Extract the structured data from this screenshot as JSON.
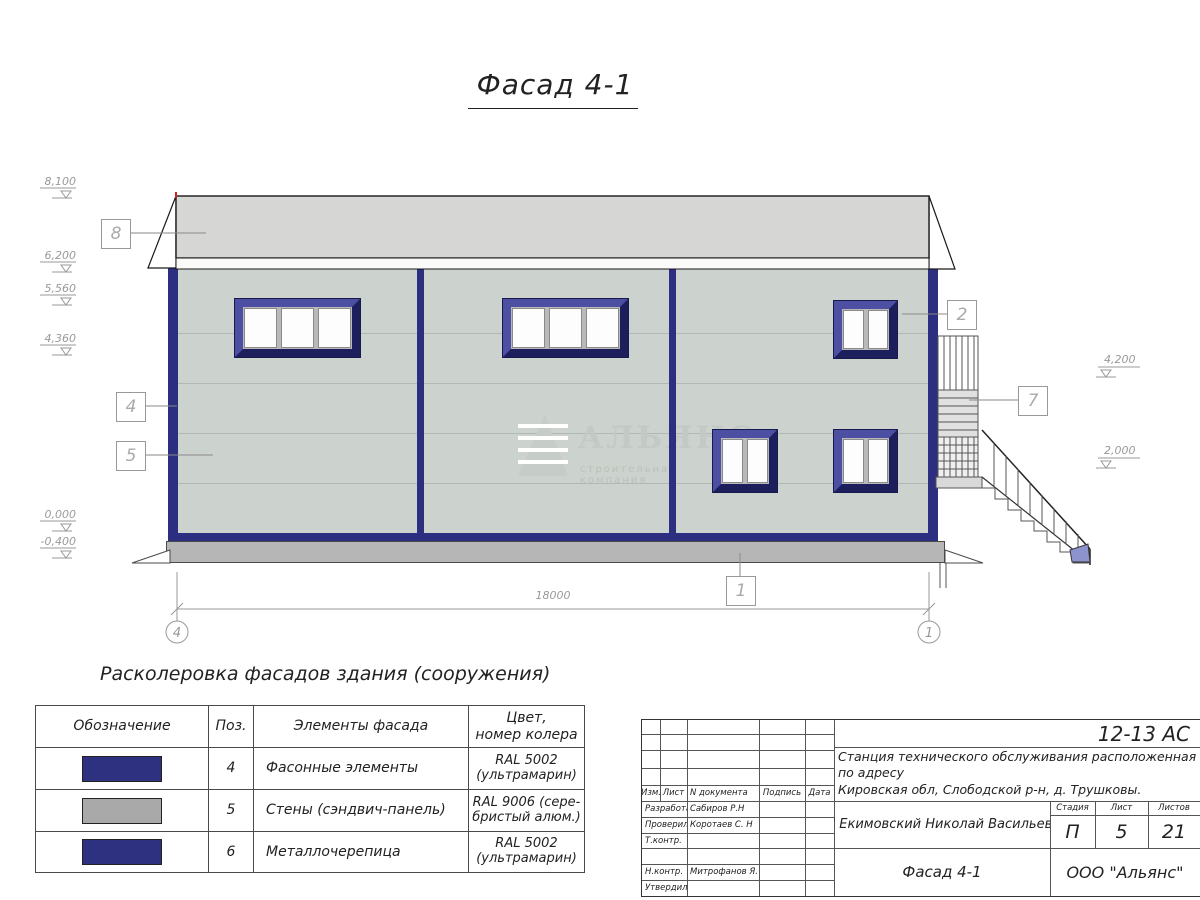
{
  "title": "Фасад 4-1",
  "colors": {
    "accent_navy": "#2e3180",
    "wall_gray_green": "#ccd2ce",
    "roof_gray": "#d6d7d5",
    "swatch_gray": "#a9a9a9"
  },
  "facade": {
    "elevations": [
      "8,100",
      "6,200",
      "5,560",
      "4,360",
      "0,000",
      "-0,400",
      "4,200",
      "2,000"
    ],
    "callouts": [
      "8",
      "4",
      "5",
      "2",
      "7",
      "1"
    ],
    "dimension_total": "18000",
    "axes": [
      "4",
      "1"
    ],
    "watermark": {
      "name": "АЛЬЯНС",
      "subtitle": "строительная компания"
    }
  },
  "legend": {
    "heading": "Расколеровка фасадов здания (сооружения)",
    "columns": {
      "c1": "Обозначение",
      "c2": "Поз.",
      "c3": "Элементы фасада",
      "c4a": "Цвет,",
      "c4b": "номер колера"
    },
    "rows": [
      {
        "pos": "4",
        "element": "Фасонные элементы",
        "color1": "RAL 5002",
        "color2": "(ультрамарин)",
        "swatch": "#2e3180"
      },
      {
        "pos": "5",
        "element": "Стены (сэндвич-панель)",
        "color1": "RAL 9006 (сере-",
        "color2": "бристый алюм.)",
        "swatch": "#a9a9a9"
      },
      {
        "pos": "6",
        "element": "Металлочерепица",
        "color1": "RAL 5002",
        "color2": "(ультрамарин)",
        "swatch": "#2e3180"
      }
    ]
  },
  "titleblock": {
    "code": "12-13 АС",
    "address_line1": "Станция технического обслуживания расположенная по адресу",
    "address_line2": "Кировская обл, Слободской р-н, д. Трушковы.",
    "rev_headers": [
      "Изм.",
      "Лист",
      "N документа",
      "Подпись",
      "Дата"
    ],
    "sign_rows": [
      {
        "role": "Разработал",
        "name": "Сабиров Р.Н"
      },
      {
        "role": "Проверил",
        "name": "Коротаев С. Н"
      },
      {
        "role": "Т.контр.",
        "name": ""
      },
      {
        "role": "",
        "name": ""
      },
      {
        "role": "Н.контр.",
        "name": "Митрофанов Я. А"
      },
      {
        "role": "Утвердил",
        "name": ""
      }
    ],
    "client": "ИП Екимовский Николай Васильевич",
    "sheet_title": "Фасад 4-1",
    "stage_headers": [
      "Стадия",
      "Лист",
      "Листов"
    ],
    "stage_values": [
      "П",
      "5",
      "21"
    ],
    "org": "ООО \"Альянс\""
  }
}
